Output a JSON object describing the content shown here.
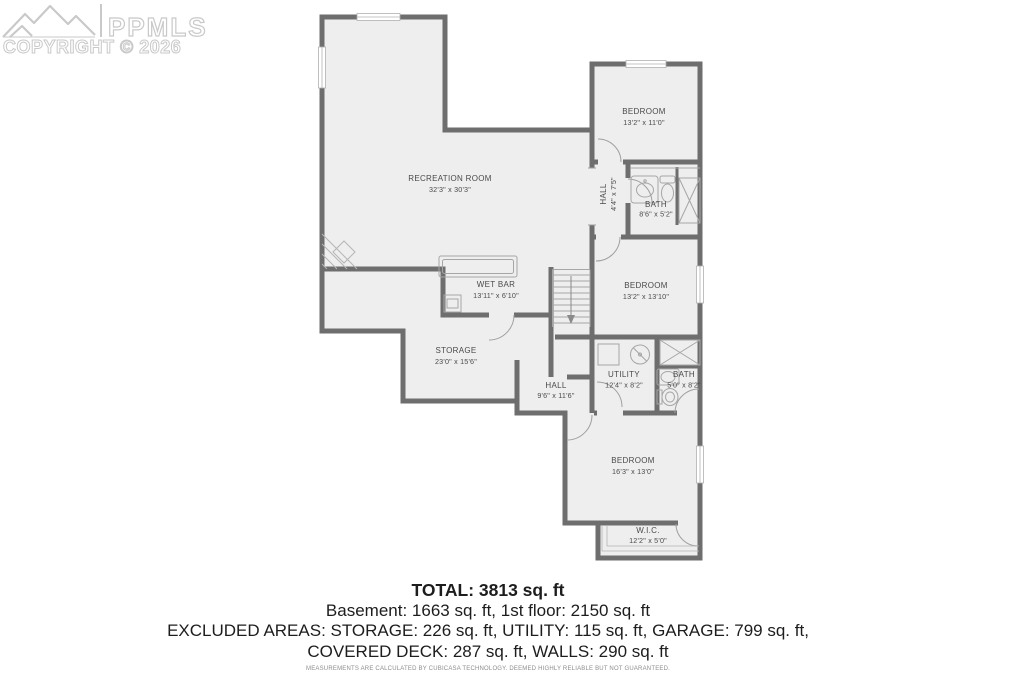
{
  "watermark": {
    "logo": "mountain-range-logo",
    "brand": "PPMLS",
    "copyright": "COPYRIGHT © 2026"
  },
  "rooms": [
    {
      "name": "RECREATION ROOM",
      "dims": "32'3\" x 30'3\""
    },
    {
      "name": "WET BAR",
      "dims": "13'11\" x 6'10\""
    },
    {
      "name": "BEDROOM",
      "dims": "13'2\" x 11'0\""
    },
    {
      "name": "HALL",
      "dims": "4'4\" x 7'5\""
    },
    {
      "name": "BATH",
      "dims": "8'6\" x 5'2\""
    },
    {
      "name": "BEDROOM",
      "dims": "13'2\" x 13'10\""
    },
    {
      "name": "STORAGE",
      "dims": "23'0\" x 15'6\""
    },
    {
      "name": "HALL",
      "dims": "9'6\" x 11'6\""
    },
    {
      "name": "UTILITY",
      "dims": "12'4\" x 8'2\""
    },
    {
      "name": "BATH",
      "dims": "5'0\" x 8'2\""
    },
    {
      "name": "BEDROOM",
      "dims": "16'3\" x 13'0\""
    },
    {
      "name": "W.I.C.",
      "dims": "12'2\" x 5'0\""
    }
  ],
  "summary": {
    "total": "TOTAL: 3813 sq. ft",
    "floors": "Basement: 1663 sq. ft, 1st floor: 2150 sq. ft",
    "excluded1": "EXCLUDED AREAS: STORAGE: 226 sq. ft, UTILITY: 115 sq. ft, GARAGE: 799 sq. ft,",
    "excluded2": "COVERED DECK: 287 sq. ft, WALLS: 290 sq. ft",
    "disclaimer": "MEASUREMENTS ARE CALCULATED BY CUBICASA TECHNOLOGY. DEEMED HIGHLY RELIABLE BUT NOT GUARANTEED."
  },
  "colors": {
    "wall": "#6e6e6e",
    "floor": "#efeeee",
    "thin_detail": "#a6a6a6",
    "label": "#4a4a4a",
    "watermark": "#c9c9c9",
    "summary_text": "#1d1d1d"
  }
}
